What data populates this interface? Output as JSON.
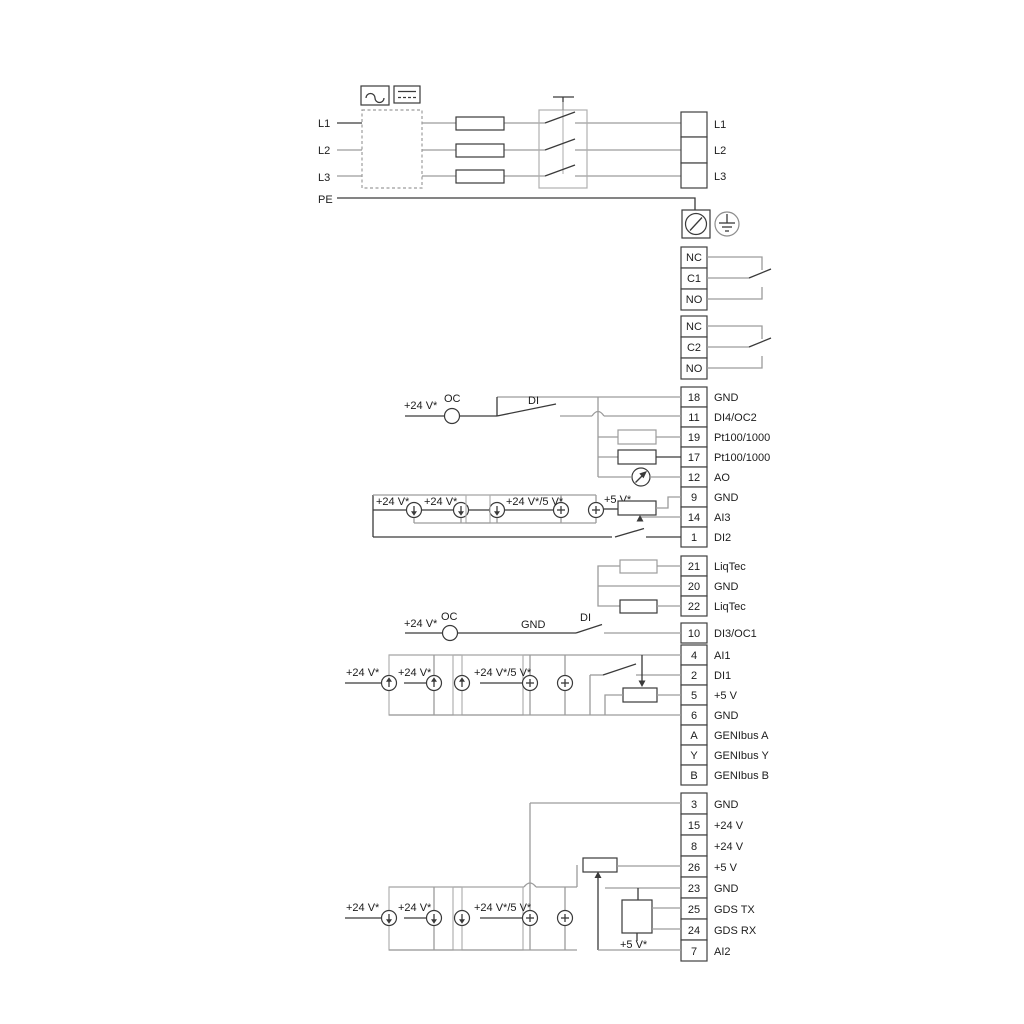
{
  "power": {
    "inputs": [
      "L1",
      "L2",
      "L3",
      "PE"
    ],
    "outputs": [
      "L1",
      "L2",
      "L3"
    ]
  },
  "relays": [
    {
      "terminals": [
        "NC",
        "C1",
        "NO"
      ]
    },
    {
      "terminals": [
        "NC",
        "C2",
        "NO"
      ]
    }
  ],
  "io_top": {
    "terminals": [
      {
        "no": "18",
        "label": "GND"
      },
      {
        "no": "11",
        "label": "DI4/OC2"
      },
      {
        "no": "19",
        "label": "Pt100/1000"
      },
      {
        "no": "17",
        "label": "Pt100/1000"
      },
      {
        "no": "12",
        "label": "AO"
      },
      {
        "no": "9",
        "label": "GND"
      },
      {
        "no": "14",
        "label": "AI3"
      },
      {
        "no": "1",
        "label": "DI2"
      }
    ]
  },
  "liqtec": {
    "terminals": [
      {
        "no": "21",
        "label": "LiqTec"
      },
      {
        "no": "20",
        "label": "GND"
      },
      {
        "no": "22",
        "label": "LiqTec"
      }
    ]
  },
  "io_mid": {
    "terminals": [
      {
        "no": "10",
        "label": "DI3/OC1"
      },
      {
        "no": "4",
        "label": "AI1"
      },
      {
        "no": "2",
        "label": "DI1"
      },
      {
        "no": "5",
        "label": "+5 V"
      },
      {
        "no": "6",
        "label": "GND"
      },
      {
        "no": "A",
        "label": "GENIbus A"
      },
      {
        "no": "Y",
        "label": "GENIbus Y"
      },
      {
        "no": "B",
        "label": "GENIbus B"
      }
    ]
  },
  "io_bottom": {
    "terminals": [
      {
        "no": "3",
        "label": "GND"
      },
      {
        "no": "15",
        "label": "+24 V"
      },
      {
        "no": "8",
        "label": "+24 V"
      },
      {
        "no": "26",
        "label": "+5 V"
      },
      {
        "no": "23",
        "label": "GND"
      },
      {
        "no": "25",
        "label": "GDS TX"
      },
      {
        "no": "24",
        "label": "GDS RX"
      },
      {
        "no": "7",
        "label": "AI2"
      }
    ]
  },
  "ann": {
    "v24": "+24 V*",
    "v24_5": "+24 V*/5 V*",
    "v5": "+5 V*",
    "oc": "OC",
    "di": "DI",
    "gnd": "GND"
  },
  "colors": {
    "background": "#ffffff",
    "wire_gray": "#9c9c9c",
    "line_dark": "#3a3a3a"
  }
}
